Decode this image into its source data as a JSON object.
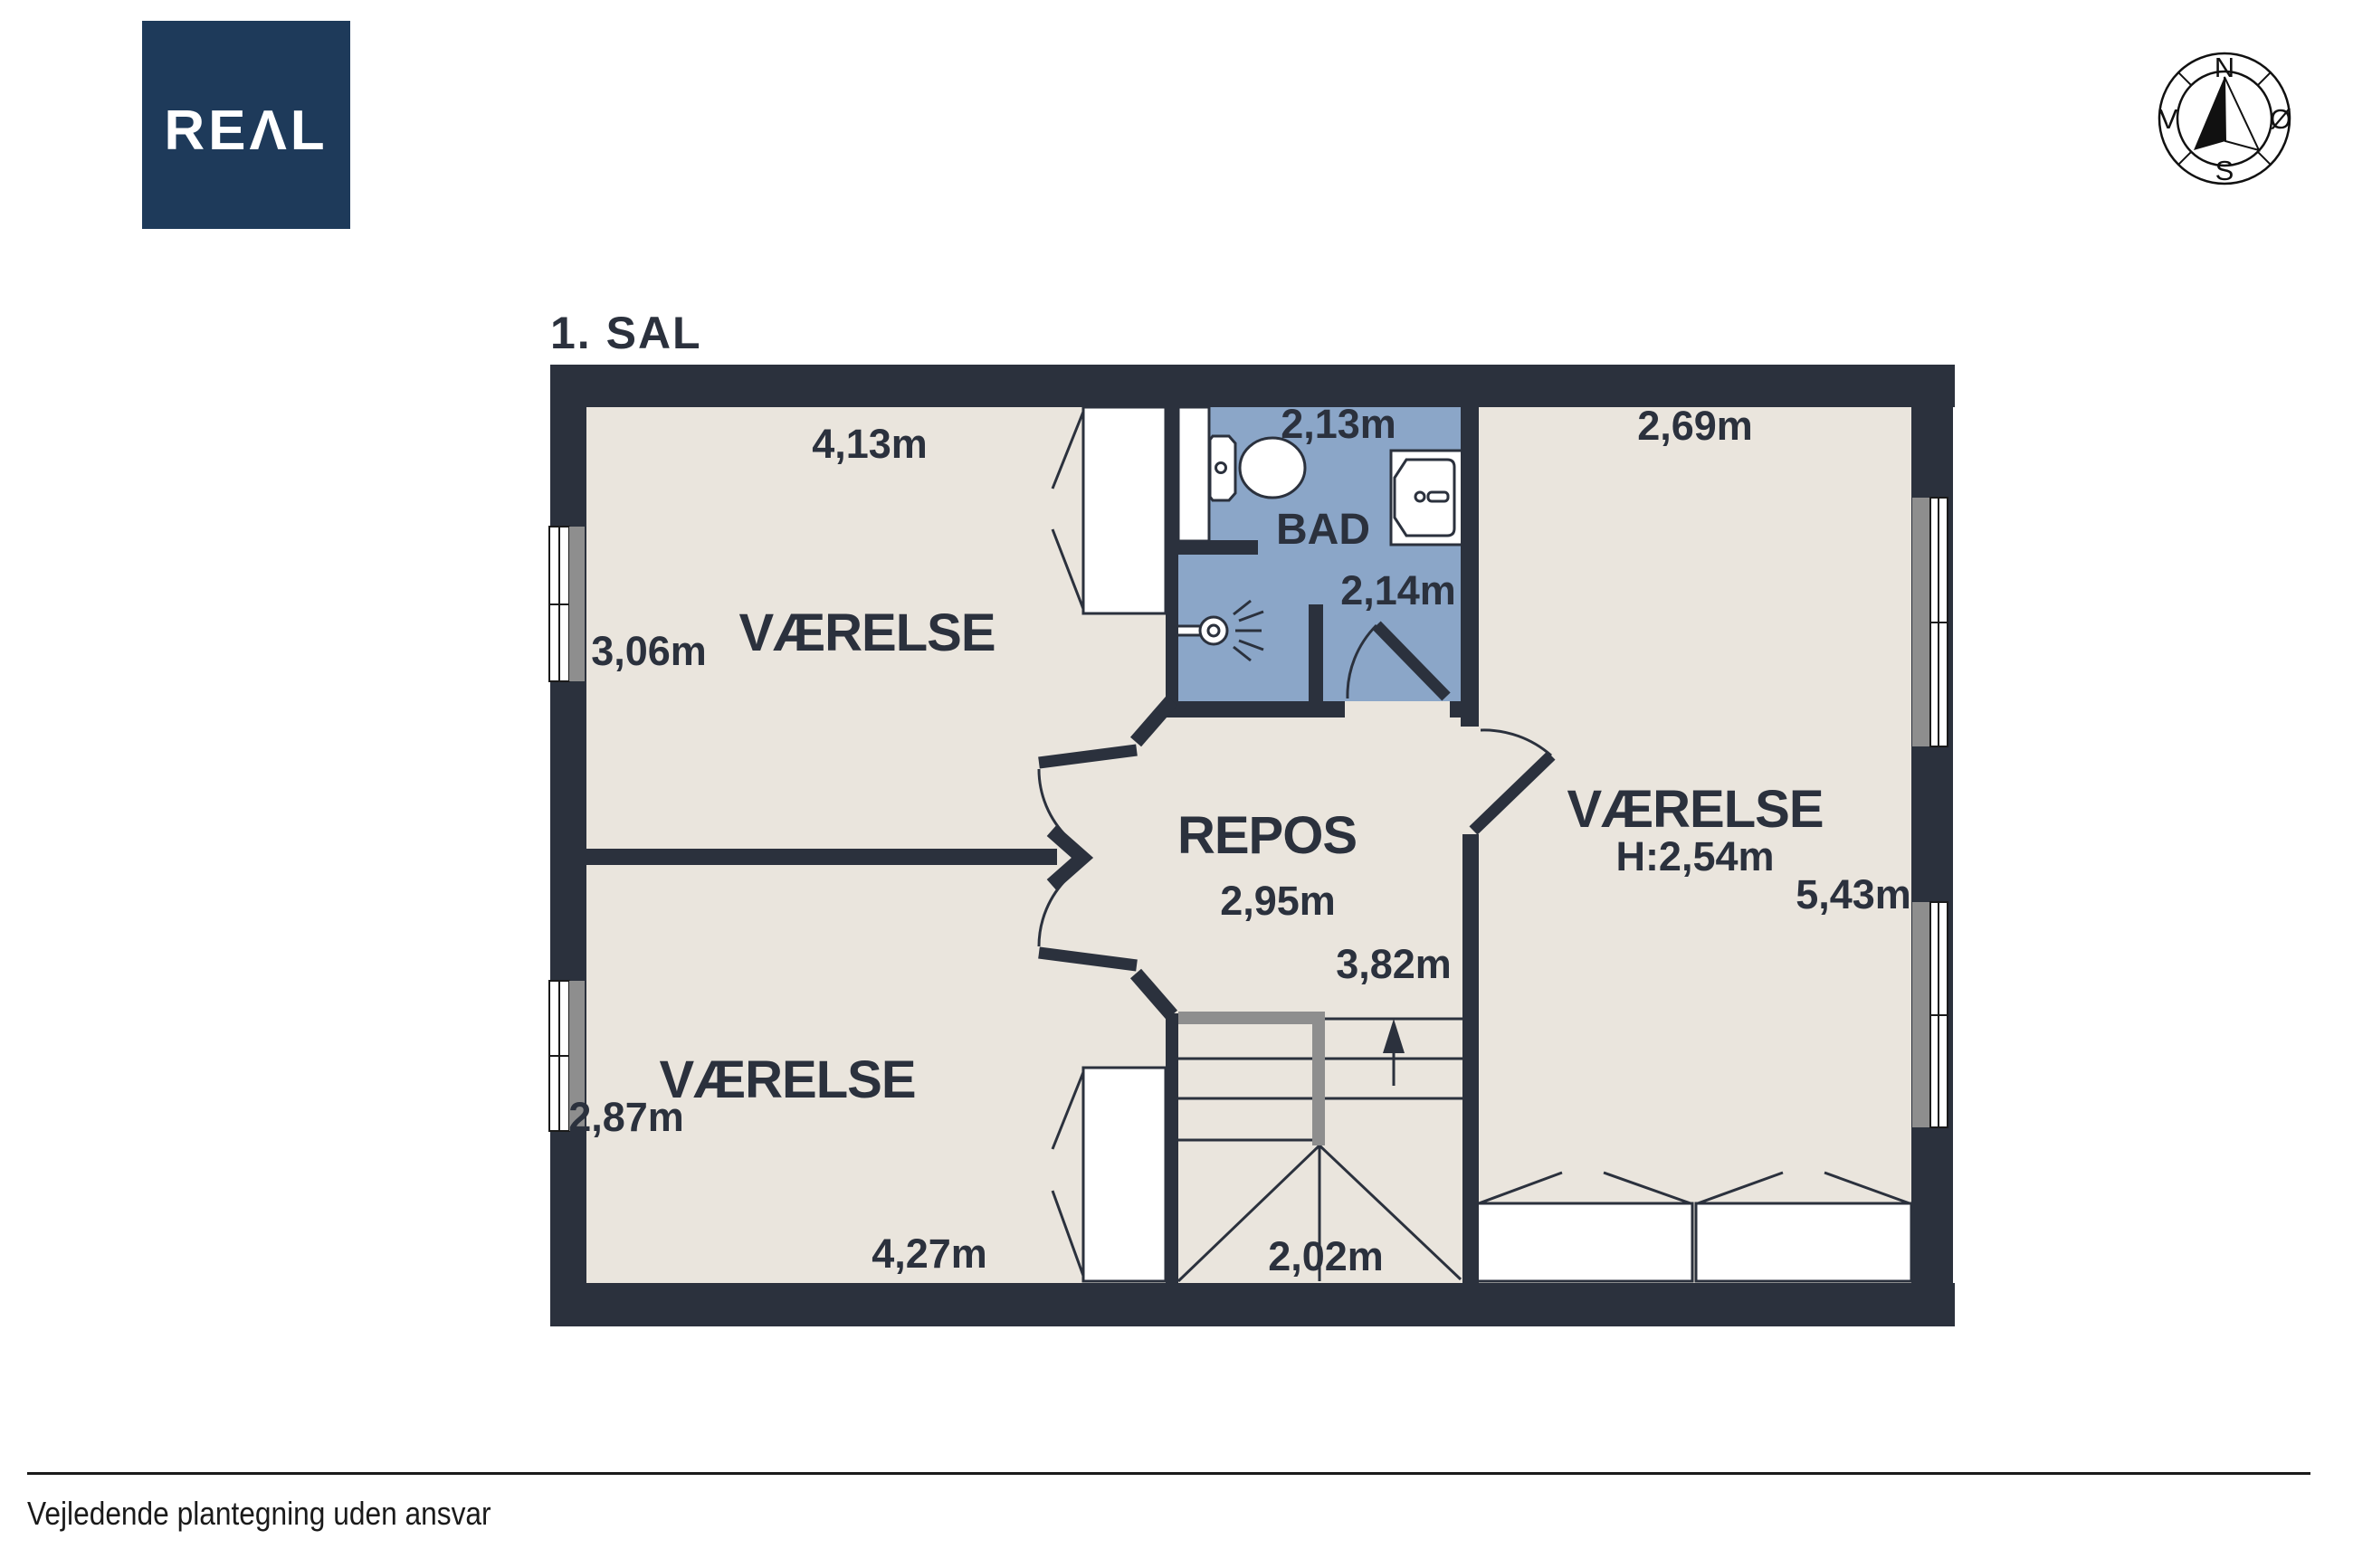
{
  "logo": {
    "text": "REAL",
    "display_text": "REΛL",
    "bg_color": "#1e3a5a"
  },
  "compass": {
    "north": "N",
    "east": "Ø",
    "south": "S",
    "west": "V"
  },
  "plan": {
    "title": "1. SAL",
    "rooms": {
      "nw": {
        "name": "VÆRELSE",
        "width_label": "4,13m",
        "depth_label": "3,06m"
      },
      "bad": {
        "name": "BAD",
        "width_label": "2,13m",
        "door_label": "2,14m"
      },
      "east": {
        "name": "VÆRELSE",
        "ceiling_label": "H:2,54m",
        "width_label": "2,69m",
        "depth_label": "5,43m"
      },
      "repos": {
        "name": "REPOS",
        "width_label": "2,95m",
        "depth_label": "3,82m"
      },
      "sw": {
        "name": "VÆRELSE",
        "width_label": "4,27m",
        "depth_label": "2,87m"
      },
      "stairs": {
        "width_label": "2,02m"
      }
    }
  },
  "footer": {
    "disclaimer": "Vejledende plantegning uden ansvar"
  },
  "colors": {
    "wall": "#2b313d",
    "floor": "#eae5dd",
    "bathroom": "#8ba6c8",
    "railing": "#8e8e8e",
    "logo": "#1e3a5a",
    "ink": "#1a1a1a"
  }
}
